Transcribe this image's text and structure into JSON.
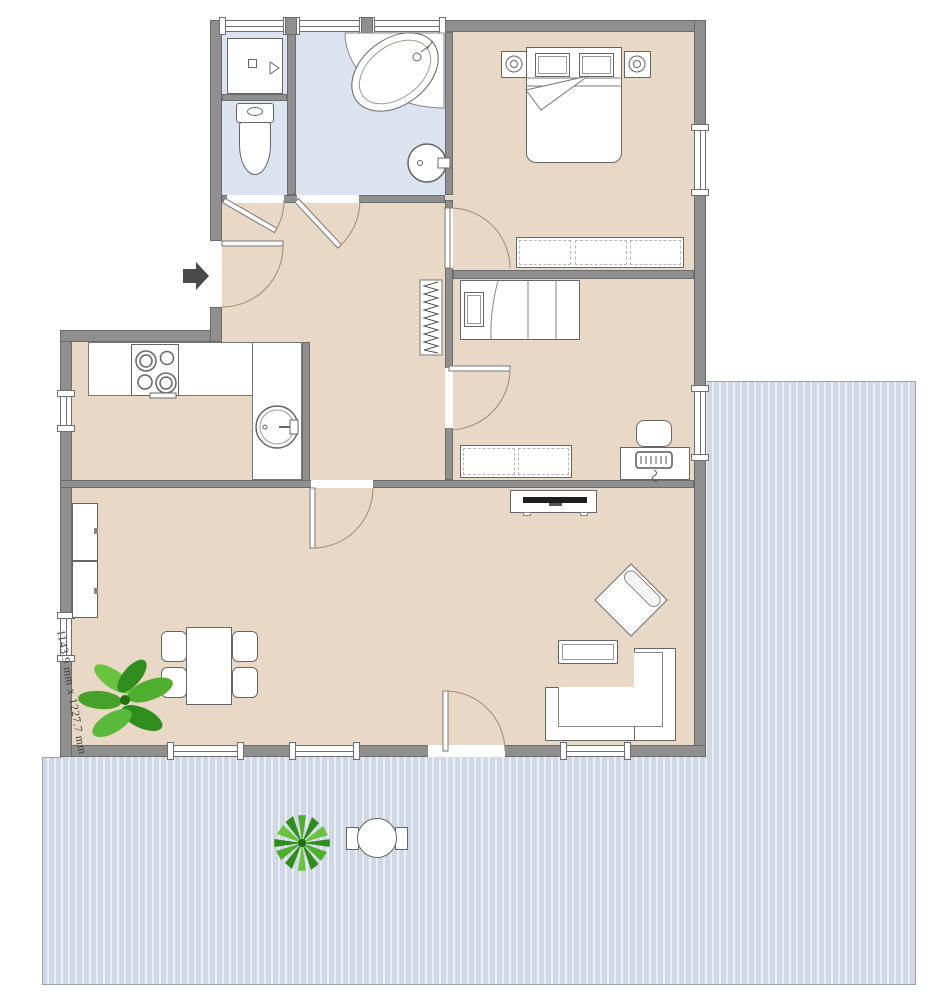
{
  "dimension_label": "1143.9 mm x 1227.7 mm",
  "colors": {
    "wall": "#8f8f8f",
    "wall-edge": "#6b6b6b",
    "floor-main": "#e9d8c6",
    "floor-bath": "#dce3f0",
    "deck-base": "#cfd8e4",
    "deck-stripe": "#eaeef5",
    "deck-edge": "#99a3b3",
    "door-arc": "#a28a6e",
    "plant-dark": "#2f8d1d",
    "plant-mid": "#4fae2e",
    "plant-light": "#6ac23f",
    "arrow": "#4a4a4a"
  },
  "rooms": [
    {
      "name": "bathroom-wc"
    },
    {
      "name": "bathroom-main"
    },
    {
      "name": "bedroom"
    },
    {
      "name": "bedroom-small"
    },
    {
      "name": "hallway"
    },
    {
      "name": "kitchen"
    },
    {
      "name": "living-room"
    },
    {
      "name": "deck"
    }
  ],
  "objects": [
    "shower",
    "toilet",
    "bathtub",
    "washbasin",
    "double-bed",
    "nightstand-lamp",
    "wardrobe",
    "single-bed",
    "radiator",
    "dresser",
    "desk",
    "desk-chair",
    "kitchen-counter",
    "stove",
    "kitchen-sink",
    "cabinet",
    "dining-table",
    "dining-chair",
    "potted-plant",
    "tv-stand",
    "tv",
    "armchair",
    "coffee-table",
    "corner-sofa",
    "outdoor-table",
    "outdoor-chair",
    "outdoor-plant",
    "entrance-arrow"
  ]
}
